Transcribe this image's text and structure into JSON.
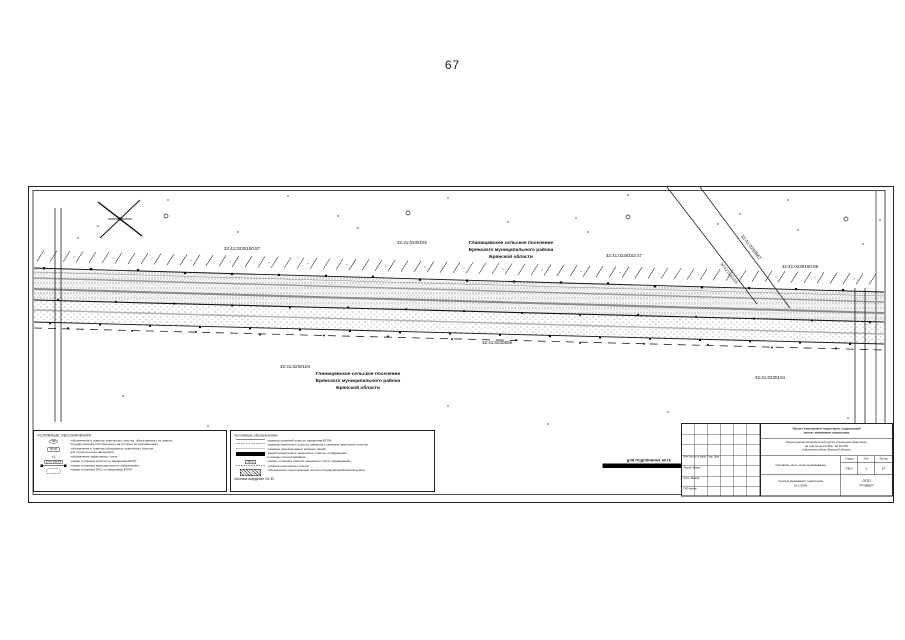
{
  "page": {
    "number": "67"
  },
  "map": {
    "labels": {
      "p87": "32:41:0230150:87",
      "p192": "32:41:0230192",
      "p162": "32:41:0230162:47",
      "p567": "32:41:0230567",
      "p153": "32:41:0230153",
      "p89": "32:41:0230150:89",
      "p506": "32:41:0230506",
      "p104a": "32:41:0230104",
      "p104b": "32:41:0230104"
    },
    "settlement_top": {
      "line1": "Глинищевское сельское поселение",
      "line2": "Брянского муниципального района",
      "line3": "Брянской области"
    },
    "settlement_bottom": {
      "line1": "Глинищевское сельское поселение",
      "line2": "Брянского муниципального района",
      "line3": "Брянской области"
    }
  },
  "legend_left": {
    "title": "УСЛОВНЫЕ ОБОЗНАЧЕНИЯ",
    "items": [
      {
        "sym": ":86",
        "lines": [
          "-обозначение и границы земельного участка, образованного из земель,",
          "государственная собственность на которые не разграничена"
        ]
      },
      {
        "sym": ":87(2)",
        "lines": [
          "-обозначение и границы образуемого земельного участка",
          "для строительства автодороги"
        ]
      },
      {
        "sym": "+1",
        "lines": [
          "-обозначение характерных точек"
        ]
      },
      {
        "sym": "32:41:0230104",
        "lines": [
          "-номер и граница участка по сведениям ЕГРН"
        ]
      },
      {
        "sym": "",
        "lines": [
          "-номер и граница муниципального образования"
        ]
      },
      {
        "sym": "",
        "lines": [
          "-номер и граница ОКС по сведениям ЕГРН"
        ]
      }
    ]
  },
  "legend_right": {
    "title": "Условные обозначения",
    "items": [
      {
        "lines": [
          "-граница охранной зоны по сведениям ЕГРН"
        ]
      },
      {
        "lines": [
          "-граница земельного участка, имеющего смежные земельные участки"
        ]
      },
      {
        "lines": [
          "-границы проектируемых красных линий"
        ]
      },
      {
        "lines": [
          "-кадастровый номер земельного участка, попадающего",
          "в границы проектирования"
        ]
      },
      {
        "sym": "38(1)",
        "lines": [
          "-номер и граница участка, имеющего статус «временный»"
        ]
      },
      {
        "lines": [
          "-граница населенного пункта"
        ]
      },
      {
        "lines": [
          "-обозначение существующей полосы отвода автомобильной дороги"
        ]
      }
    ],
    "footer": "Система координат СК-32"
  },
  "stamp": {
    "line1": "ДЛЯ ПОДЛИННИКА АКТА"
  },
  "title_block": {
    "doc_title_1": "Проект планировки территории, содержащий",
    "doc_title_2": "проект межевания территории",
    "object_1": "Реконструкция автомобильной дороги «Глинищево-Жирятино»",
    "object_2": "на участке км 13+500 - км 26+500",
    "object_3": "в Брянском районе Брянской области",
    "section": "Основная часть проекта межевания",
    "stage_h": [
      "Стадия",
      "Лист",
      "Листов"
    ],
    "stage_v": [
      "ПМ-1",
      "3",
      "67"
    ],
    "sheet_name_1": "Чертеж межевания территории",
    "sheet_name_2": "М 1:2000",
    "company_1": "ООО",
    "company_2": "«Глэвис»",
    "sig_header": "Изм. Кол.уч  № докум.  Подп.  Дата",
    "sig_rows": [
      "Разраб.  Иванов",
      "Пров.  Иванова",
      "ГИП  Иванов"
    ]
  }
}
